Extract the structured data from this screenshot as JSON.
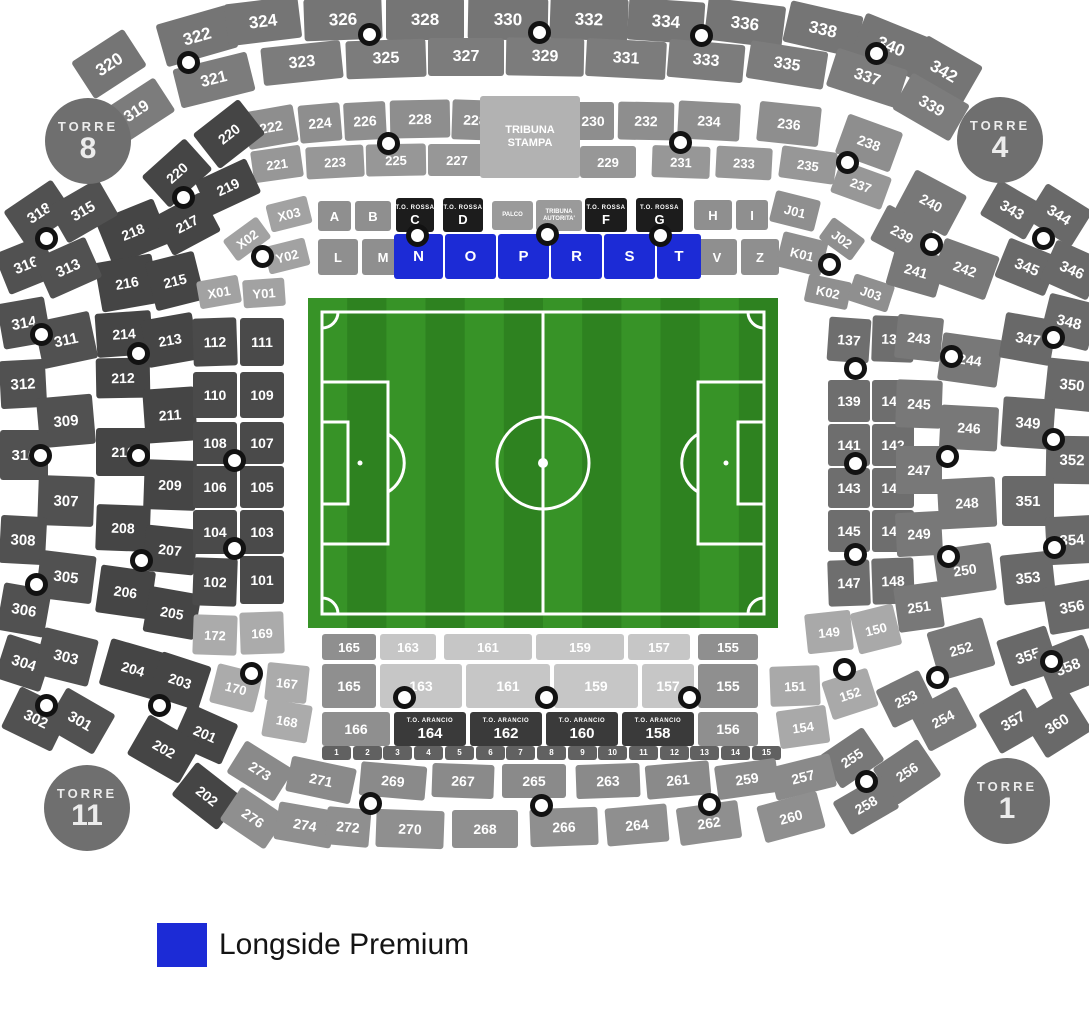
{
  "legend": {
    "label": "Longside Premium",
    "swatch_color": "#1c2bd6"
  },
  "towers": [
    {
      "name": "TORRE",
      "number": "8"
    },
    {
      "name": "TORRE",
      "number": "4"
    },
    {
      "name": "TORRE",
      "number": "11"
    },
    {
      "name": "TORRE",
      "number": "1"
    }
  ],
  "pitch": {
    "grass_base": "#379327",
    "grass_stripe": "#2e8220",
    "line_color": "#ffffff"
  },
  "sections": {
    "outer_top_r1": [
      "320",
      "322",
      "324",
      "326",
      "328",
      "330",
      "332",
      "334",
      "336",
      "338",
      "340",
      "342"
    ],
    "outer_top_r2": [
      "319",
      "321",
      "323",
      "325",
      "327",
      "329",
      "331",
      "333",
      "335",
      "337",
      "339"
    ],
    "ring2_r1": [
      "222",
      "224",
      "226",
      "228",
      "228",
      "230",
      "232",
      "234",
      "236",
      "238"
    ],
    "ring2_r2": [
      "221",
      "223",
      "225",
      "227",
      "229",
      "231",
      "233",
      "235",
      "237"
    ],
    "ring2_left": [
      "220",
      "220",
      "219",
      "218",
      "217",
      "216",
      "215",
      "214",
      "213",
      "212",
      "211",
      "210",
      "209",
      "208",
      "207",
      "206",
      "205",
      "204",
      "203",
      "201",
      "202",
      "202"
    ],
    "tribuna_stampa": [
      {
        "line1": "TRIBUNA",
        "line2": "STAMPA"
      }
    ],
    "letters_plain": [
      "X03",
      "A",
      "B",
      "H",
      "I",
      "J01",
      "Y02",
      "L",
      "M",
      "V",
      "Z",
      "K01",
      "X02",
      "X01",
      "Y01",
      "J02",
      "K02",
      "J03"
    ],
    "letters_dark": [
      {
        "top": "T.O. ROSSA",
        "main": "C"
      },
      {
        "top": "T.O. ROSSA",
        "main": "D"
      },
      {
        "top": "T.O. ROSSA",
        "main": "F"
      },
      {
        "top": "T.O. ROSSA",
        "main": "G"
      }
    ],
    "letters_gray_small": [
      "PALCO",
      "TRIBUNA AUTORITA'"
    ],
    "premium": [
      "N",
      "O",
      "P",
      "R",
      "S",
      "T"
    ],
    "inner_left": [
      "112",
      "111",
      "110",
      "109",
      "108",
      "107",
      "106",
      "105",
      "104",
      "103",
      "102",
      "101"
    ],
    "inner_left_bottom": [
      "172",
      "169",
      "170",
      "167",
      "168"
    ],
    "bottom_rowA": [
      "165",
      "163",
      "161",
      "159",
      "157",
      "155"
    ],
    "bottom_rowB": [
      "165",
      "163",
      "161",
      "159",
      "157",
      "155"
    ],
    "bottom_rowC": [
      "166",
      "156"
    ],
    "arancio": [
      {
        "top": "T.O. ARANCIO",
        "main": "164"
      },
      {
        "top": "T.O. ARANCIO",
        "main": "162"
      },
      {
        "top": "T.O. ARANCIO",
        "main": "160"
      },
      {
        "top": "T.O. ARANCIO",
        "main": "158"
      }
    ],
    "strip": [
      "1",
      "2",
      "3",
      "4",
      "5",
      "6",
      "7",
      "8",
      "9",
      "10",
      "11",
      "12",
      "13",
      "14",
      "15"
    ],
    "inner_right_corner": [
      "149",
      "150",
      "151",
      "152",
      "154"
    ],
    "inner_right": [
      "137",
      "138",
      "139",
      "140",
      "141",
      "142",
      "143",
      "144",
      "145",
      "146",
      "147",
      "148"
    ],
    "mid_right": [
      "240",
      "239",
      "241",
      "242",
      "243",
      "244",
      "245",
      "246",
      "247",
      "248",
      "249",
      "250",
      "251",
      "252",
      "253",
      "254",
      "255",
      "256",
      "258"
    ],
    "outer_right": [
      "343",
      "344",
      "345",
      "346",
      "348",
      "347",
      "350",
      "349",
      "352",
      "351",
      "354",
      "353",
      "356",
      "355",
      "358",
      "357",
      "360"
    ],
    "outer_left": [
      "318",
      "315",
      "316",
      "313",
      "314",
      "311",
      "312",
      "309",
      "310",
      "307",
      "308",
      "305",
      "306",
      "304",
      "303",
      "302",
      "301"
    ],
    "bottom_r1": [
      "273",
      "271",
      "269",
      "267",
      "265",
      "263",
      "261",
      "259",
      "257"
    ],
    "bottom_r2": [
      "276",
      "274",
      "272",
      "270",
      "268",
      "266",
      "264",
      "262",
      "260"
    ]
  }
}
